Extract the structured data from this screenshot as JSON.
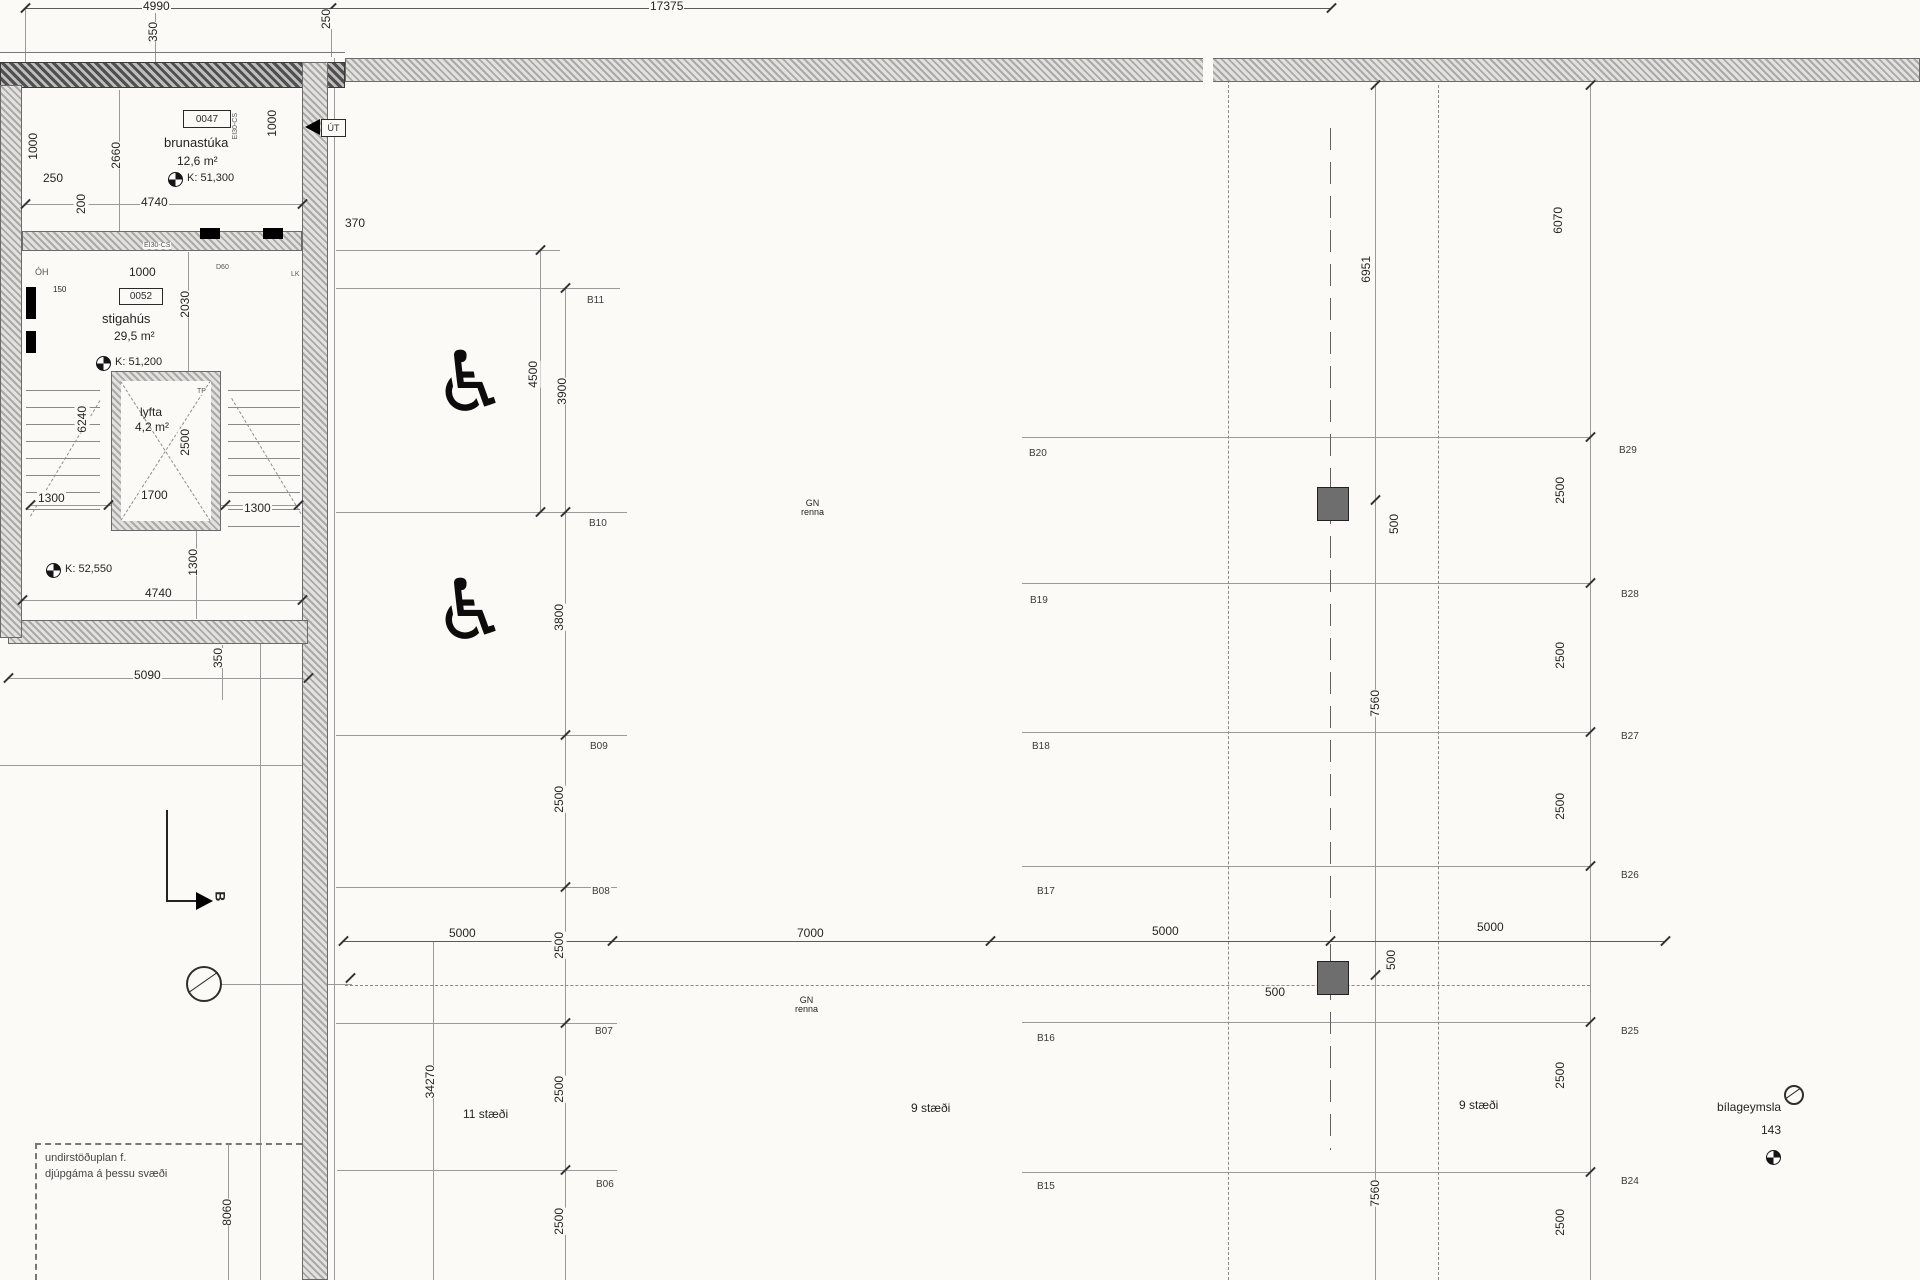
{
  "rooms": [
    {
      "id": "0047",
      "name": "brunastúka",
      "area": "12,6 m²",
      "level": "K: 51,300"
    },
    {
      "id": "0052",
      "name": "stigahús",
      "area": "29,5 m²",
      "level": "K: 51,200"
    },
    {
      "name": "lyfta",
      "area": "4,2 m²"
    }
  ],
  "levels": {
    "k52550": "K: 52,550"
  },
  "exit": {
    "label": "ÚT"
  },
  "section": {
    "label": "B"
  },
  "drain": {
    "line1": "GN",
    "line2": "renna"
  },
  "parking": [
    "11 stæði",
    "9 stæði",
    "9 stæði"
  ],
  "garage": {
    "name": "bílageymsla",
    "value": "143"
  },
  "note": {
    "line1": "undirstöðuplan f.",
    "line2": "djúpgáma á þessu svæði"
  },
  "dim_labels": [
    {
      "t": "4990",
      "x": 142,
      "y": 0
    },
    {
      "t": "350",
      "x": 146,
      "y": 22,
      "rot": 1
    },
    {
      "t": "250",
      "x": 319,
      "y": 9,
      "rot": 1
    },
    {
      "t": "17375",
      "x": 649,
      "y": 0
    },
    {
      "t": "2660",
      "x": 109,
      "y": 142,
      "rot": 1
    },
    {
      "t": "1000",
      "x": 26,
      "y": 133,
      "rot": 1
    },
    {
      "t": "250",
      "x": 42,
      "y": 172
    },
    {
      "t": "200",
      "x": 74,
      "y": 194,
      "rot": 1
    },
    {
      "t": "4740",
      "x": 140,
      "y": 196
    },
    {
      "t": "1000",
      "x": 265,
      "y": 110,
      "rot": 1
    },
    {
      "t": "370",
      "x": 344,
      "y": 217
    },
    {
      "t": "1000",
      "x": 128,
      "y": 266
    },
    {
      "t": "2030",
      "x": 178,
      "y": 291,
      "rot": 1
    },
    {
      "t": "150",
      "x": 52,
      "y": 286,
      "s": 8
    },
    {
      "t": "6240",
      "x": 75,
      "y": 406,
      "rot": 1
    },
    {
      "t": "2500",
      "x": 178,
      "y": 429,
      "rot": 1
    },
    {
      "t": "1300",
      "x": 37,
      "y": 492
    },
    {
      "t": "1700",
      "x": 140,
      "y": 489
    },
    {
      "t": "1300",
      "x": 243,
      "y": 502
    },
    {
      "t": "1300",
      "x": 186,
      "y": 549,
      "rot": 1
    },
    {
      "t": "4740",
      "x": 144,
      "y": 587
    },
    {
      "t": "5090",
      "x": 133,
      "y": 669
    },
    {
      "t": "350",
      "x": 211,
      "y": 648,
      "rot": 1
    },
    {
      "t": "4500",
      "x": 526,
      "y": 361,
      "rot": 1
    },
    {
      "t": "3900",
      "x": 555,
      "y": 378,
      "rot": 1
    },
    {
      "t": "3800",
      "x": 552,
      "y": 604,
      "rot": 1
    },
    {
      "t": "2500",
      "x": 552,
      "y": 786,
      "rot": 1
    },
    {
      "t": "2500",
      "x": 552,
      "y": 932,
      "rot": 1
    },
    {
      "t": "2500",
      "x": 552,
      "y": 1076,
      "rot": 1
    },
    {
      "t": "2500",
      "x": 552,
      "y": 1208,
      "rot": 1
    },
    {
      "t": "5000",
      "x": 448,
      "y": 927
    },
    {
      "t": "7000",
      "x": 796,
      "y": 927
    },
    {
      "t": "5000",
      "x": 1151,
      "y": 925
    },
    {
      "t": "5000",
      "x": 1476,
      "y": 921
    },
    {
      "t": "500",
      "x": 1264,
      "y": 986
    },
    {
      "t": "500",
      "x": 1384,
      "y": 950,
      "rot": 1
    },
    {
      "t": "500",
      "x": 1387,
      "y": 514,
      "rot": 1
    },
    {
      "t": "6951",
      "x": 1359,
      "y": 256,
      "rot": 1
    },
    {
      "t": "7560",
      "x": 1368,
      "y": 690,
      "rot": 1
    },
    {
      "t": "7560",
      "x": 1368,
      "y": 1180,
      "rot": 1
    },
    {
      "t": "6070",
      "x": 1551,
      "y": 207,
      "rot": 1
    },
    {
      "t": "2500",
      "x": 1553,
      "y": 477,
      "rot": 1
    },
    {
      "t": "2500",
      "x": 1553,
      "y": 642,
      "rot": 1
    },
    {
      "t": "2500",
      "x": 1553,
      "y": 793,
      "rot": 1
    },
    {
      "t": "2500",
      "x": 1553,
      "y": 1062,
      "rot": 1
    },
    {
      "t": "2500",
      "x": 1553,
      "y": 1209,
      "rot": 1
    },
    {
      "t": "8060",
      "x": 220,
      "y": 1199,
      "rot": 1
    },
    {
      "t": "34270",
      "x": 423,
      "y": 1065,
      "rot": 1
    }
  ],
  "grid_labels": [
    {
      "t": "B11",
      "x": 586,
      "y": 296
    },
    {
      "t": "B10",
      "x": 588,
      "y": 519
    },
    {
      "t": "B09",
      "x": 589,
      "y": 742
    },
    {
      "t": "B08",
      "x": 591,
      "y": 887
    },
    {
      "t": "B07",
      "x": 594,
      "y": 1027
    },
    {
      "t": "B06",
      "x": 595,
      "y": 1180
    },
    {
      "t": "B20",
      "x": 1028,
      "y": 449
    },
    {
      "t": "B19",
      "x": 1029,
      "y": 596
    },
    {
      "t": "B18",
      "x": 1031,
      "y": 742
    },
    {
      "t": "B17",
      "x": 1036,
      "y": 887
    },
    {
      "t": "B16",
      "x": 1036,
      "y": 1034
    },
    {
      "t": "B15",
      "x": 1036,
      "y": 1182
    },
    {
      "t": "B29",
      "x": 1618,
      "y": 446
    },
    {
      "t": "B28",
      "x": 1620,
      "y": 590
    },
    {
      "t": "B27",
      "x": 1620,
      "y": 732
    },
    {
      "t": "B26",
      "x": 1620,
      "y": 871
    },
    {
      "t": "B25",
      "x": 1620,
      "y": 1027
    },
    {
      "t": "B24",
      "x": 1620,
      "y": 1177
    }
  ],
  "tiny_labels": [
    {
      "t": "EI30-CS",
      "x": 231,
      "y": 113,
      "rot": 1
    },
    {
      "t": "EI30-CS",
      "x": 143,
      "y": 242
    },
    {
      "t": "D60",
      "x": 215,
      "y": 264
    },
    {
      "t": "LK",
      "x": 290,
      "y": 271
    },
    {
      "t": "TP",
      "x": 196,
      "y": 388
    },
    {
      "t": "ÓH",
      "x": 34,
      "y": 268,
      "s": 9
    }
  ]
}
